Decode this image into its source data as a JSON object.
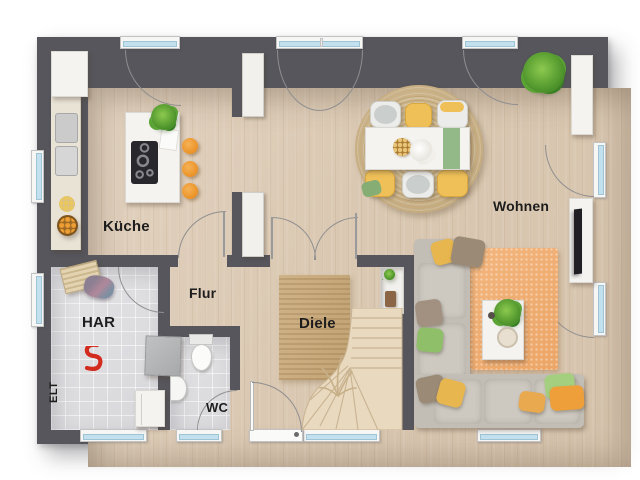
{
  "rooms": {
    "kueche": {
      "label": "Küche"
    },
    "wohnen": {
      "label": "Wohnen"
    },
    "har": {
      "label": "HAR"
    },
    "flur": {
      "label": "Flur"
    },
    "diele": {
      "label": "Diele"
    },
    "wc": {
      "label": "WC"
    },
    "elt": {
      "label": "ELT"
    }
  },
  "colors": {
    "wall": "#56565c",
    "floor_wood": "#dac8b2",
    "floor_tile": "#dedee0",
    "window_glass": "#c2e0ee",
    "stool_orange": "#ea8f22",
    "sofa_gray": "#c2beb6",
    "rug_jute": "#c9b183",
    "rug_orange": "#f0ae74",
    "runner_green": "#94b989",
    "pillow_yellow": "#e7b64e",
    "pillow_green": "#8fbf69",
    "stairs_wood": "#e9d9bf",
    "valve_red": "#d32b1e"
  },
  "inventory": [
    "kitchen-tall-cabinet",
    "kitchen-counter",
    "kitchen-sink",
    "fruit-bowl",
    "kitchen-island",
    "cooktop",
    "bar-stool-x3",
    "island-plant",
    "dining-rug-round",
    "dining-table",
    "table-runner",
    "dining-chair-x6",
    "centerpiece",
    "sofa-l-shape",
    "throw-pillows",
    "living-rug",
    "coffee-table",
    "tv-lowboard",
    "tv",
    "sideboard",
    "corner-plant",
    "stairs-winder",
    "decor-grass",
    "niche-shelf",
    "hall-runner-rug",
    "front-door",
    "sidelight-window",
    "laundry-shelf",
    "washing-machine",
    "dryer",
    "red-water-valve",
    "toilet",
    "washbasin",
    "window-x10",
    "door-swing-arcs"
  ]
}
